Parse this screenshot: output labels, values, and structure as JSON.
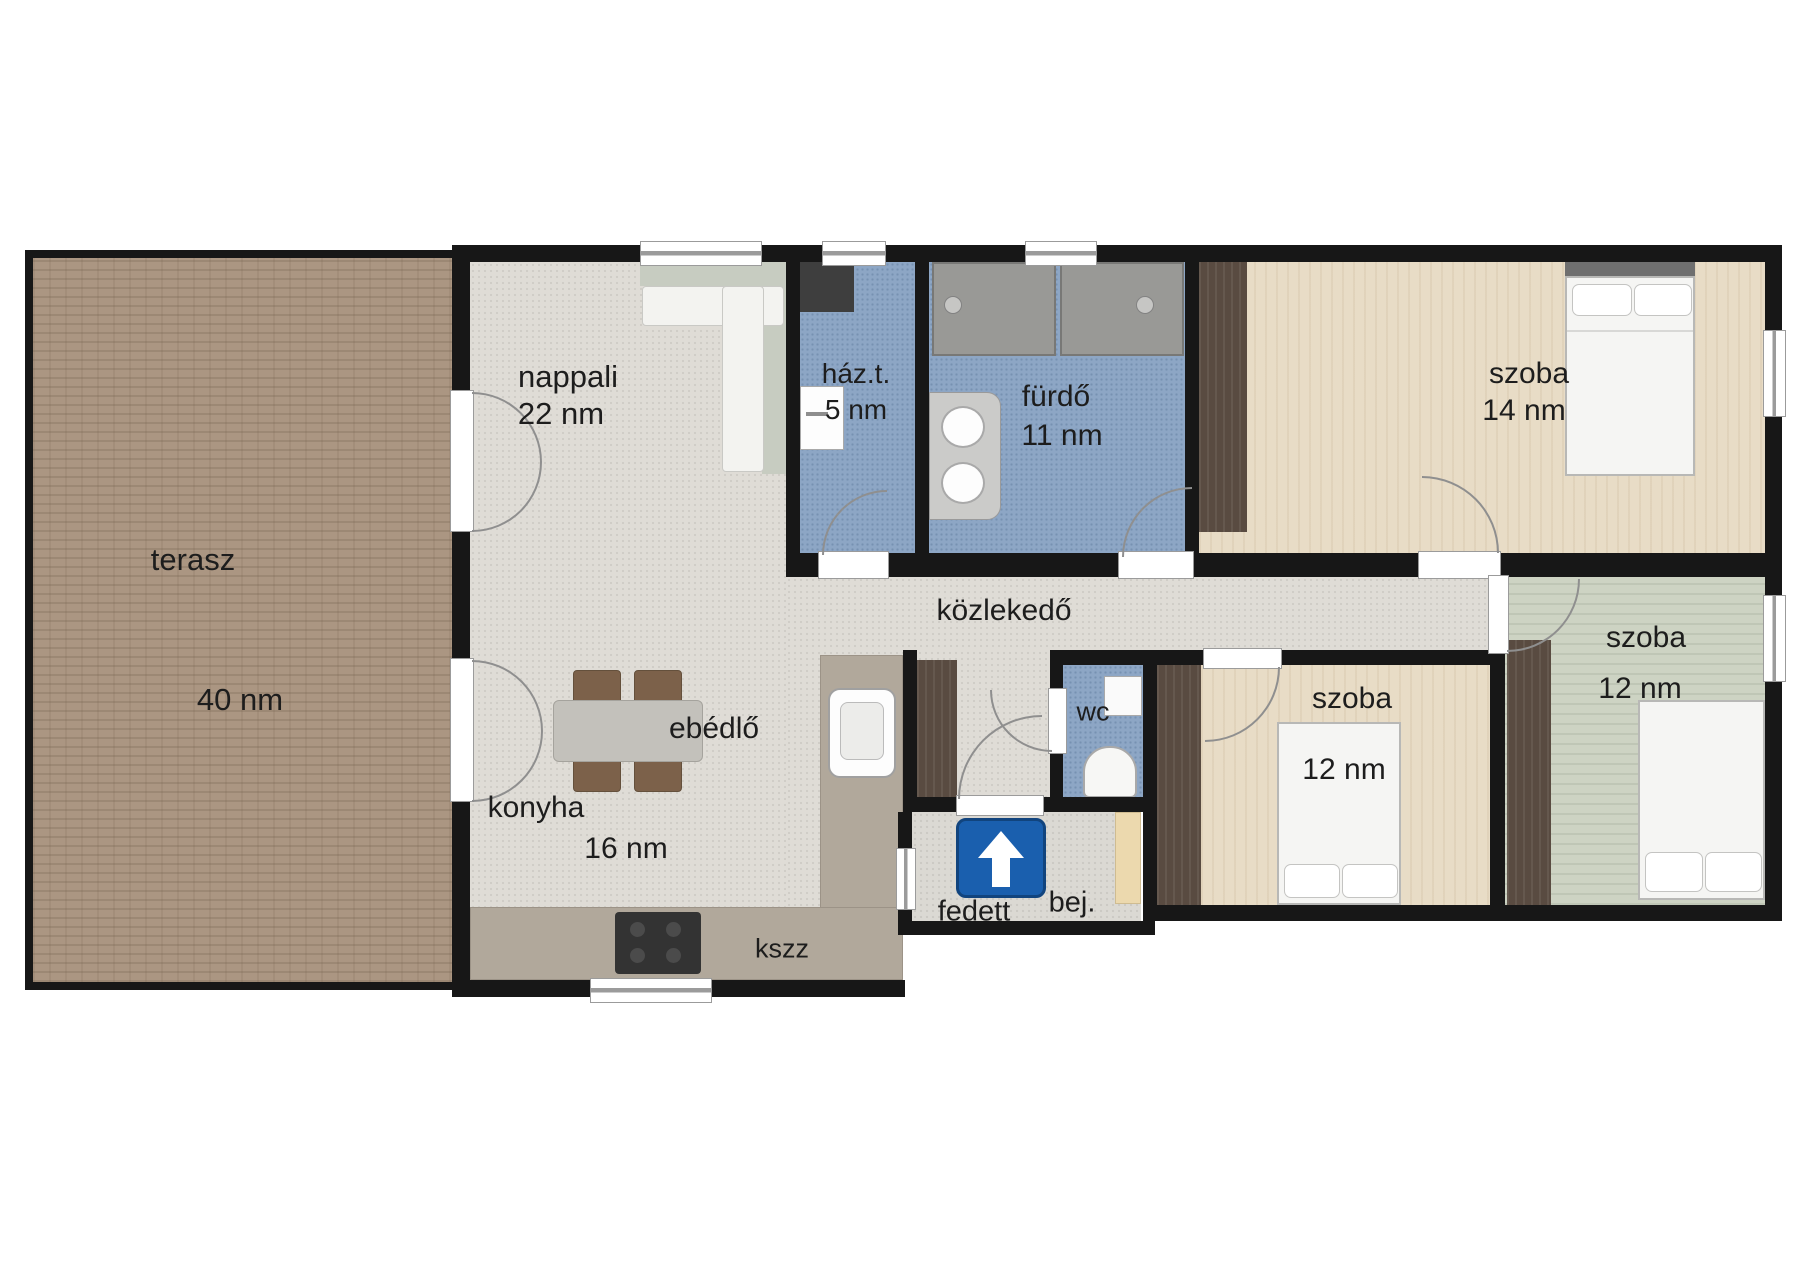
{
  "plan_title": "family house floor plan",
  "rooms": {
    "terasz": {
      "name": "terasz",
      "area": "40 nm"
    },
    "nappali": {
      "name": "nappali",
      "area": "22 nm"
    },
    "ebedlo": {
      "name": "ebédlő"
    },
    "konyha": {
      "name": "konyha",
      "area": "16 nm"
    },
    "kszz": {
      "name": "kszz"
    },
    "hazt": {
      "name": "ház.t.",
      "area": "5 nm"
    },
    "furdo": {
      "name": "fürdő",
      "area": "11 nm"
    },
    "kozlekedo": {
      "name": "közlekedő"
    },
    "wc": {
      "name": "wc"
    },
    "fedett": {
      "name": "fedett"
    },
    "bej": {
      "name": "bej."
    },
    "szoba14": {
      "name": "szoba",
      "area": "14 nm"
    },
    "szoba12a": {
      "name": "szoba",
      "area": "12 nm"
    },
    "szoba12b": {
      "name": "szoba",
      "area": "12 nm"
    }
  },
  "icons": {
    "entrance_arrow": "one-way-up-arrow-sign",
    "shower_heads": 2,
    "vanity_sinks": 2
  },
  "colors": {
    "wall": "#171717",
    "floor_pale": "#dfdcd6",
    "floor_wet": "#8da6c5",
    "floor_brick": "#ab9682",
    "floor_wood_beige": "#e8dcc6",
    "floor_wood_green": "#cdd3c3",
    "furniture_wood_dark": "#594b41",
    "counter": "#b1a89b",
    "sofa": "#c7ccc1",
    "chair_brown": "#7c614a",
    "sign_blue": "#1a5fae",
    "frame_gray": "#9b9b9b",
    "text": "#1d1d1d"
  }
}
